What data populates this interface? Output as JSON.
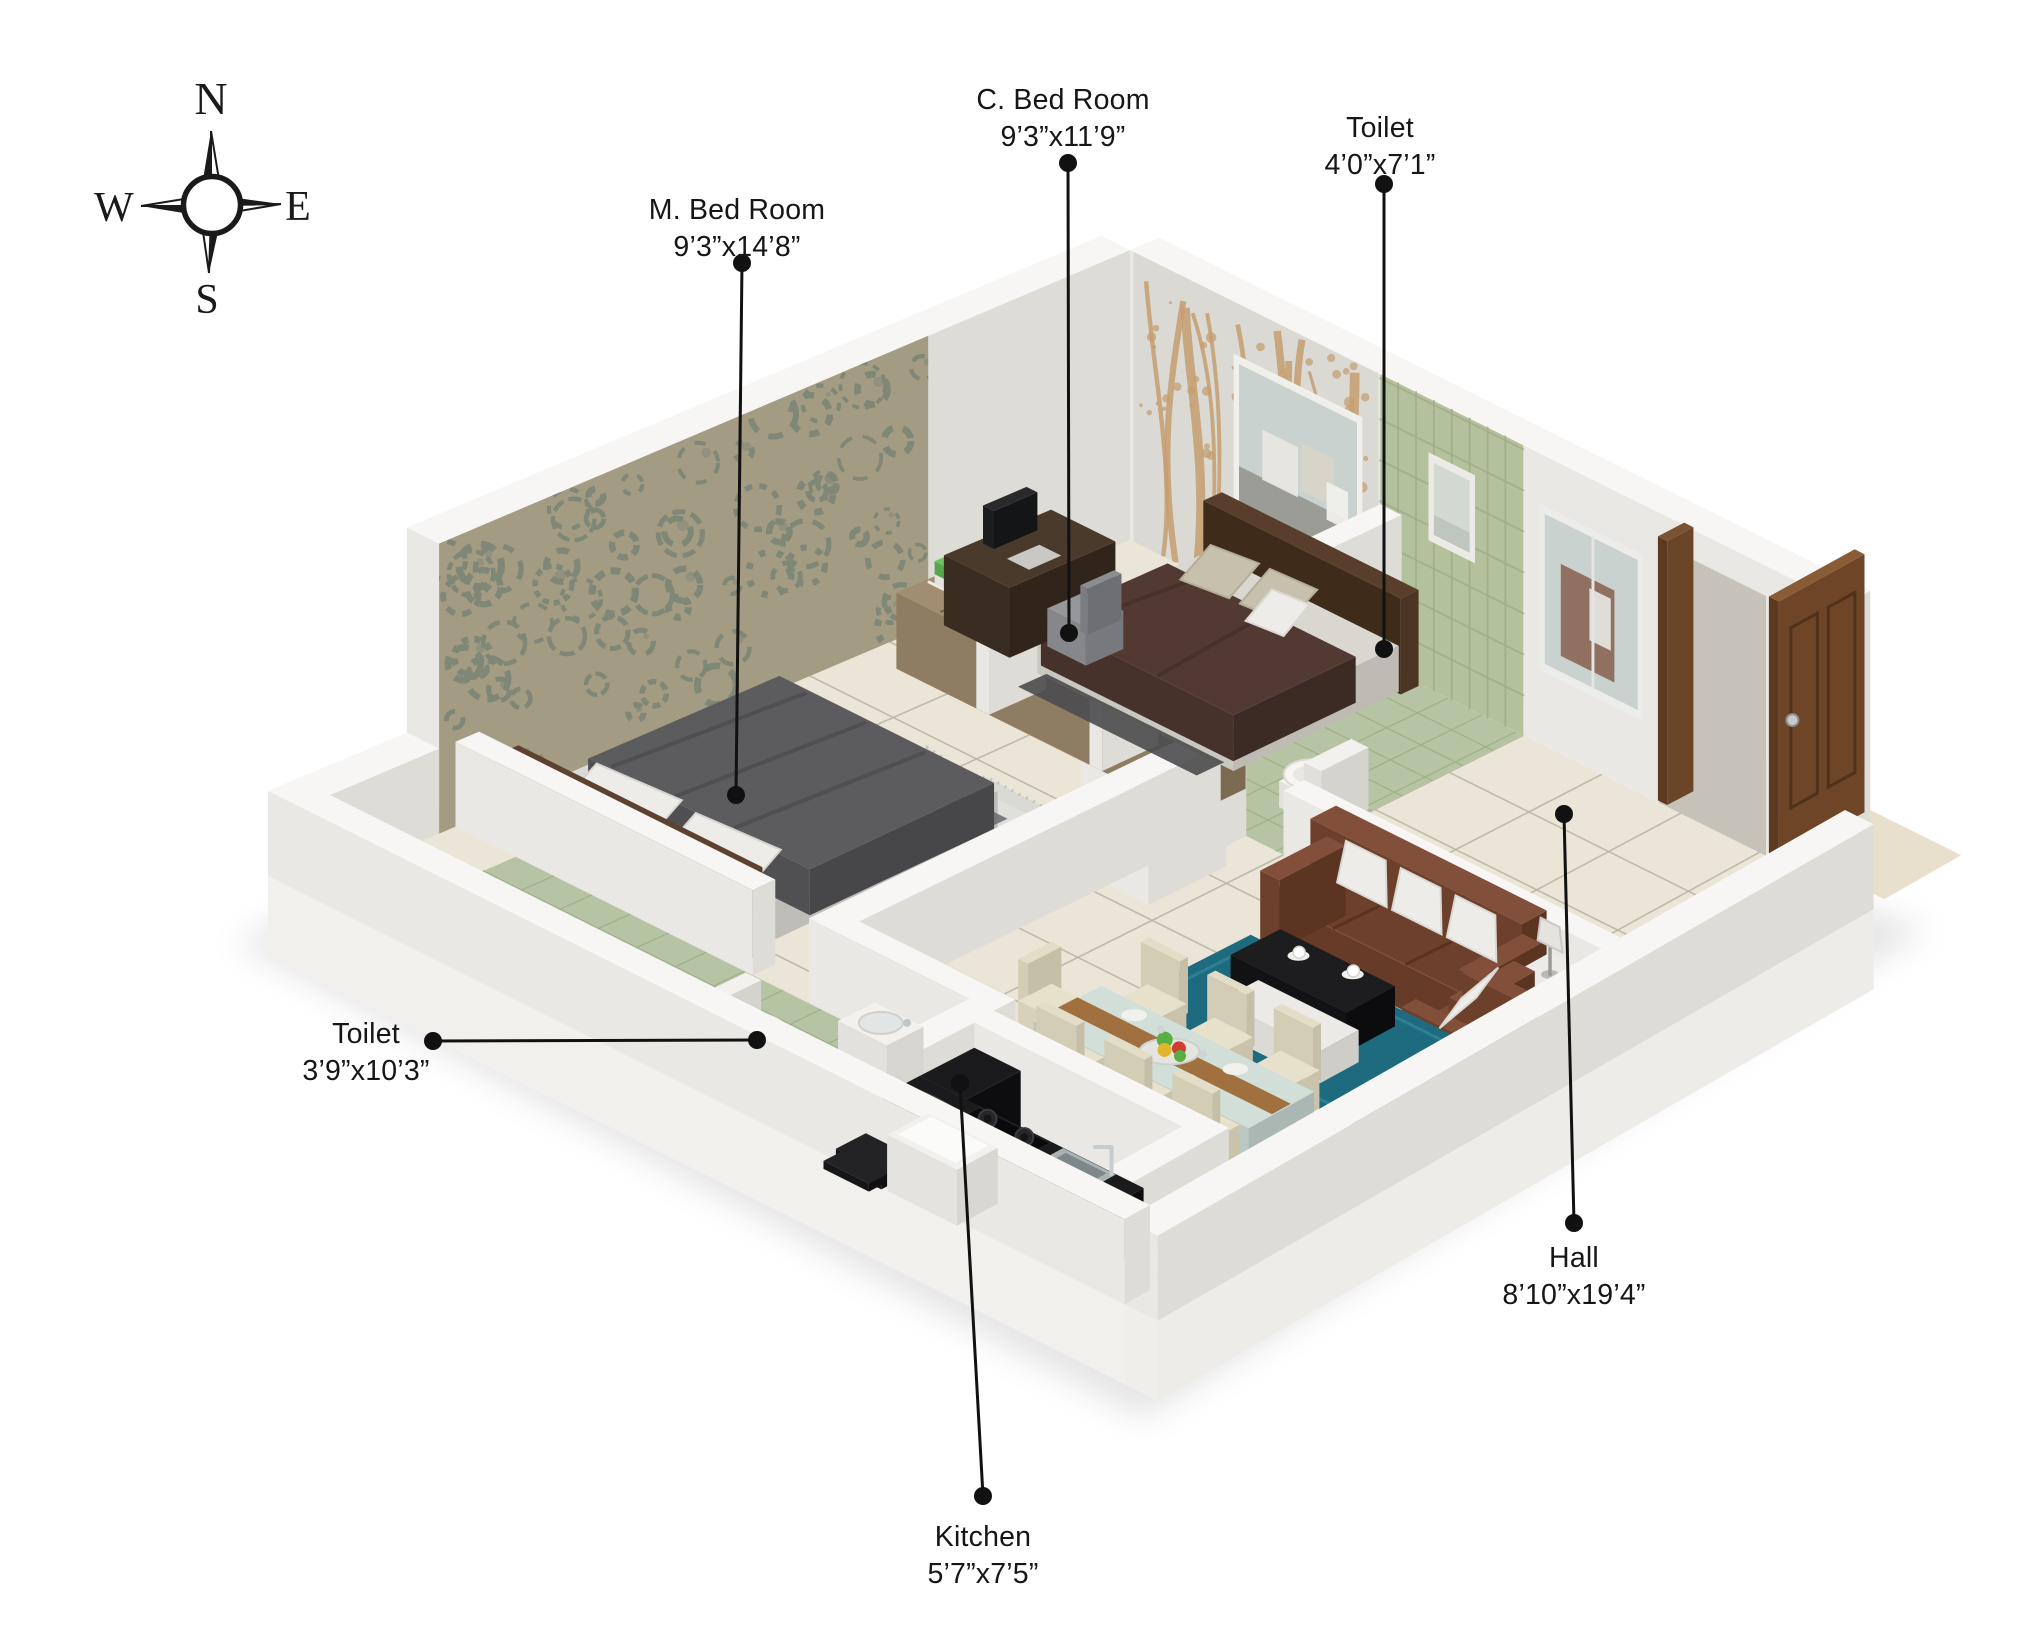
{
  "compass": {
    "north": "N",
    "east": "E",
    "south": "S",
    "west": "W"
  },
  "labels": {
    "m_bedroom": {
      "name": "M. Bed Room",
      "dims": "9’3”x14’8”"
    },
    "c_bedroom": {
      "name": "C. Bed Room",
      "dims": "9’3”x11’9”"
    },
    "toilet_top": {
      "name": "Toilet",
      "dims": "4’0”x7’1”"
    },
    "toilet_left": {
      "name": "Toilet",
      "dims": "3’9”x10’3”"
    },
    "hall": {
      "name": "Hall",
      "dims": "8’10”x19’4”"
    },
    "kitchen": {
      "name": "Kitchen",
      "dims": "5’7”x7’5”"
    }
  },
  "colors": {
    "label_text": "#161616",
    "leader_line": "#111111",
    "wall_top": "#f7f6f4",
    "wall_south": "#eae8e4",
    "wall_east": "#dedcd6",
    "floor": "#ebe5d7",
    "grout": "#b7b1a2",
    "toilet_floor": "#b7c4a4",
    "toilet_grout": "#9fae8a",
    "tile_wall": "#b3c19c",
    "damask_base": "#a49b83",
    "damask_motif": "#7f8777",
    "tree_base": "#dbd9d4",
    "tree_branch": "#c49d6f",
    "bed_gray": "#5c5c5f",
    "mattress": "#dbd9d5",
    "headboard": "#4c3526",
    "bed_maroon": "#523a33",
    "wood": "#8f7d63",
    "wood_dark": "#4a3a2c",
    "sofa": "#7b4b35",
    "rug_blue": "#1e6b80",
    "rug_gray": "#d8d8d5",
    "coffee_table": "#1d1d20",
    "counter_granite": "#1b1b1e",
    "glass": "#c9d2cf",
    "door": "#6f4527",
    "chair_cream": "#e3ddc8",
    "pillow": "#edece8",
    "accent_green": "#6fc261",
    "accent_yellow": "#e0c14a"
  }
}
